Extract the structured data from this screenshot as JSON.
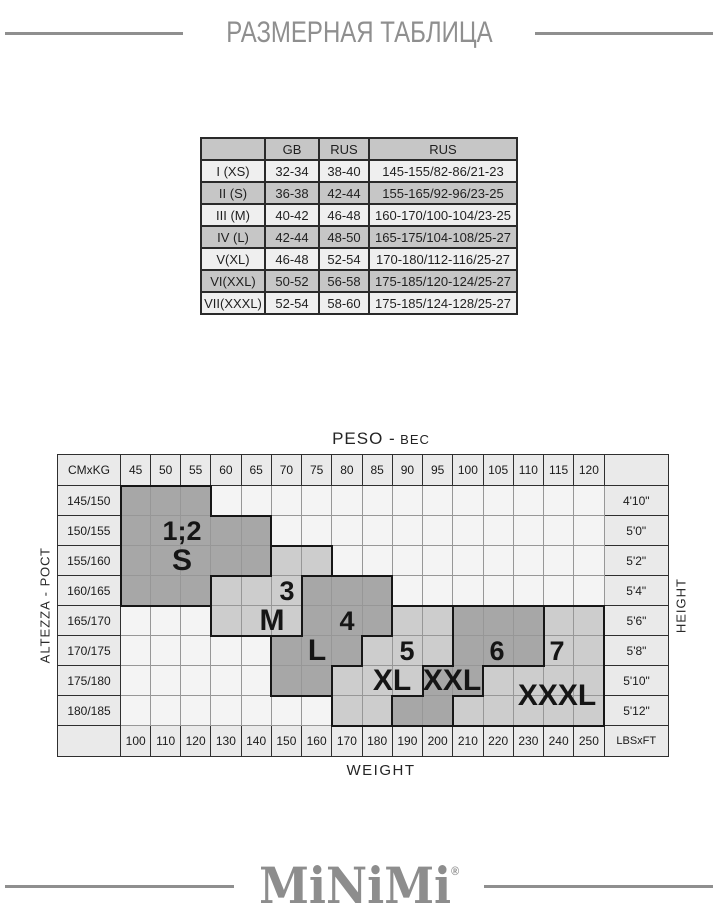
{
  "title": "РАЗМЕРНАЯ ТАБЛИЦА",
  "size_table": {
    "headers": [
      "",
      "GB",
      "RUS",
      "RUS"
    ],
    "rows": [
      [
        "I (XS)",
        "32-34",
        "38-40",
        "145-155/82-86/21-23"
      ],
      [
        "II (S)",
        "36-38",
        "42-44",
        "155-165/92-96/23-25"
      ],
      [
        "III (M)",
        "40-42",
        "46-48",
        "160-170/100-104/23-25"
      ],
      [
        "IV (L)",
        "42-44",
        "48-50",
        "165-175/104-108/25-27"
      ],
      [
        "V(XL)",
        "46-48",
        "52-54",
        "170-180/112-116/25-27"
      ],
      [
        "VI(XXL)",
        "50-52",
        "56-58",
        "175-185/120-124/25-27"
      ],
      [
        "VII(XXXL)",
        "52-54",
        "58-60",
        "175-185/124-128/25-27"
      ]
    ]
  },
  "chart_data": {
    "type": "heatmap",
    "title": "",
    "top_label_latin": "PESO -",
    "top_label_cyrillic": "ВЕС",
    "bottom_label": "WEIGHT",
    "left_label": "ALTEZZA - РОСТ",
    "right_label": "HEIGHT",
    "corner_top_left": "CMxKG",
    "corner_bottom_right": "LBSxFT",
    "weight_kg": [
      45,
      50,
      55,
      60,
      65,
      70,
      75,
      80,
      85,
      90,
      95,
      100,
      105,
      110,
      115,
      120
    ],
    "weight_lbs": [
      100,
      110,
      120,
      130,
      140,
      150,
      160,
      170,
      180,
      190,
      200,
      210,
      220,
      230,
      240,
      250
    ],
    "height_cm": [
      "145/150",
      "150/155",
      "155/160",
      "160/165",
      "165/170",
      "170/175",
      "175/180",
      "180/185"
    ],
    "height_ft": [
      "4'10\"",
      "5'0\"",
      "5'2\"",
      "5'4\"",
      "5'6\"",
      "5'8\"",
      "5'10\"",
      "5'12\""
    ],
    "region_map": [
      "SSS.............",
      "SSSSS...........",
      "SSSSSMM.........",
      "SSSMMMLLL.......",
      "...MMMLLLXX22233",
      ".....LLLXXX22233",
      ".....LLXXX223333",
      ".......XX2233333"
    ],
    "region_shades": {
      "S": "dark",
      "M": "light",
      "L": "dark",
      "X": "light",
      "2": "dark",
      "3": "light"
    },
    "region_names": {
      "S": "1;2 S",
      "M": "3 M",
      "L": "4 L",
      "X": "5 XL",
      "2": "6 XXL",
      "3": "7 XXXL"
    },
    "region_labels": [
      {
        "text": "1;2",
        "kind": "num",
        "row": 1,
        "col": 1,
        "colSpan": 2,
        "rowSpan": 1
      },
      {
        "text": "S",
        "kind": "letter",
        "row": 2,
        "col": 1,
        "colSpan": 2,
        "rowSpan": 1
      },
      {
        "text": "3",
        "kind": "num",
        "row": 3,
        "col": 5,
        "colSpan": 1,
        "rowSpan": 1
      },
      {
        "text": "M",
        "kind": "letter",
        "row": 4,
        "col": 4,
        "colSpan": 2,
        "rowSpan": 1
      },
      {
        "text": "4",
        "kind": "num",
        "row": 4,
        "col": 7,
        "colSpan": 1,
        "rowSpan": 1
      },
      {
        "text": "L",
        "kind": "letter",
        "row": 5,
        "col": 6,
        "colSpan": 1,
        "rowSpan": 1
      },
      {
        "text": "5",
        "kind": "num",
        "row": 5,
        "col": 9,
        "colSpan": 1,
        "rowSpan": 1
      },
      {
        "text": "XL",
        "kind": "letter",
        "row": 6,
        "col": 8,
        "colSpan": 2,
        "rowSpan": 1
      },
      {
        "text": "6",
        "kind": "num",
        "row": 5,
        "col": 12,
        "colSpan": 1,
        "rowSpan": 1
      },
      {
        "text": "XXL",
        "kind": "letter",
        "row": 6,
        "col": 10,
        "colSpan": 2,
        "rowSpan": 1
      },
      {
        "text": "7",
        "kind": "num",
        "row": 5,
        "col": 14,
        "colSpan": 1,
        "rowSpan": 1
      },
      {
        "text": "XXXL",
        "kind": "letter",
        "row": 6,
        "col": 13,
        "colSpan": 3,
        "rowSpan": 2
      }
    ],
    "colors": {
      "dark": "#a7a7a7",
      "light": "#cdcdcd",
      "empty": "#f4f4f4",
      "label_bg": "#eaeaea",
      "thin_border": "#979797",
      "thick_border": "#161616",
      "label_border": "#2f2f2f",
      "brand_gray": "#8f8f8f"
    }
  },
  "logo": {
    "text": "MiNiMi",
    "mark": "®"
  }
}
